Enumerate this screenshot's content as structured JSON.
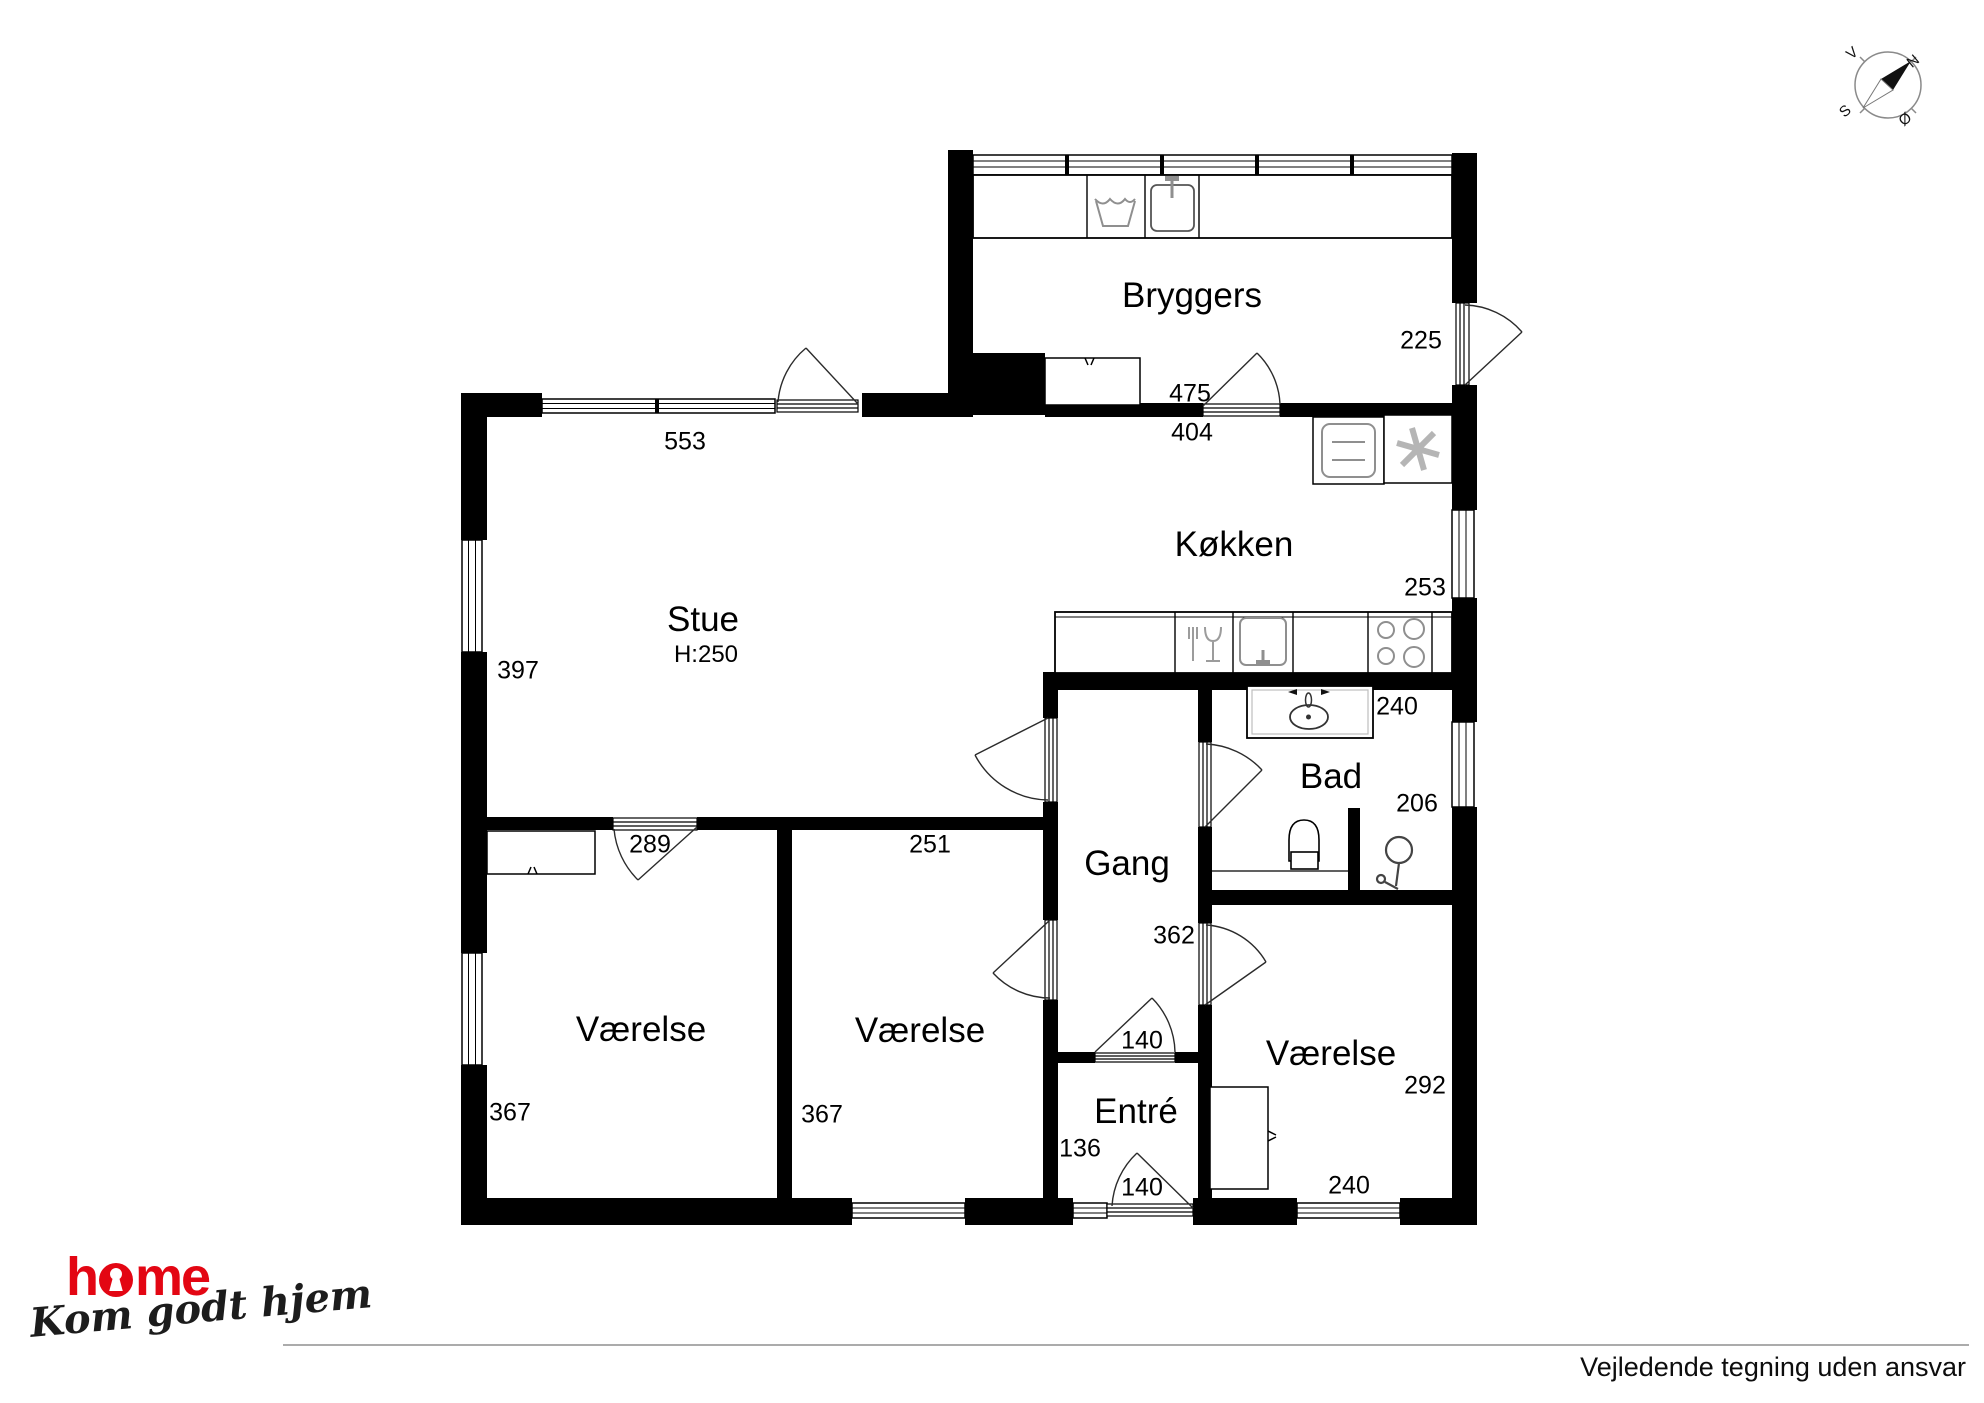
{
  "plan": {
    "rooms": {
      "bryggers": "Bryggers",
      "koekken": "Køkken",
      "stue": "Stue",
      "stue_height": "H:250",
      "gang": "Gang",
      "bad": "Bad",
      "entre": "Entré",
      "vaerelse_left": "Værelse",
      "vaerelse_mid": "Værelse",
      "vaerelse_right": "Værelse"
    },
    "measurements": {
      "stue_top": "553",
      "stue_left": "397",
      "vaerelse_left_door": "289",
      "vaerelse_mid_top": "251",
      "vaerelse_left_depth": "367",
      "vaerelse_mid_depth": "367",
      "bryggers_bottom": "475",
      "koekken_top": "404",
      "bryggers_right": "225",
      "koekken_right": "253",
      "bad_top": "240",
      "bad_right": "206",
      "gang_depth": "362",
      "entre_door_top": "140",
      "entre_width": "136",
      "entre_door_bottom": "140",
      "vaerelse_right_depth": "292",
      "vaerelse_right_bottom": "240"
    },
    "compass": {
      "north": "N",
      "south": "S",
      "east": "Ø",
      "west": "V"
    }
  },
  "footer": {
    "logo": {
      "text": "home",
      "prefix": "h",
      "suffix": "me"
    },
    "tagline": "Kom godt hjem",
    "disclaimer": "Vejledende tegning uden ansvar"
  },
  "colors": {
    "wall": "#000000",
    "brand_red": "#e30613",
    "rule_gray": "#ababab",
    "fixture_gray": "#8f8f8f"
  }
}
